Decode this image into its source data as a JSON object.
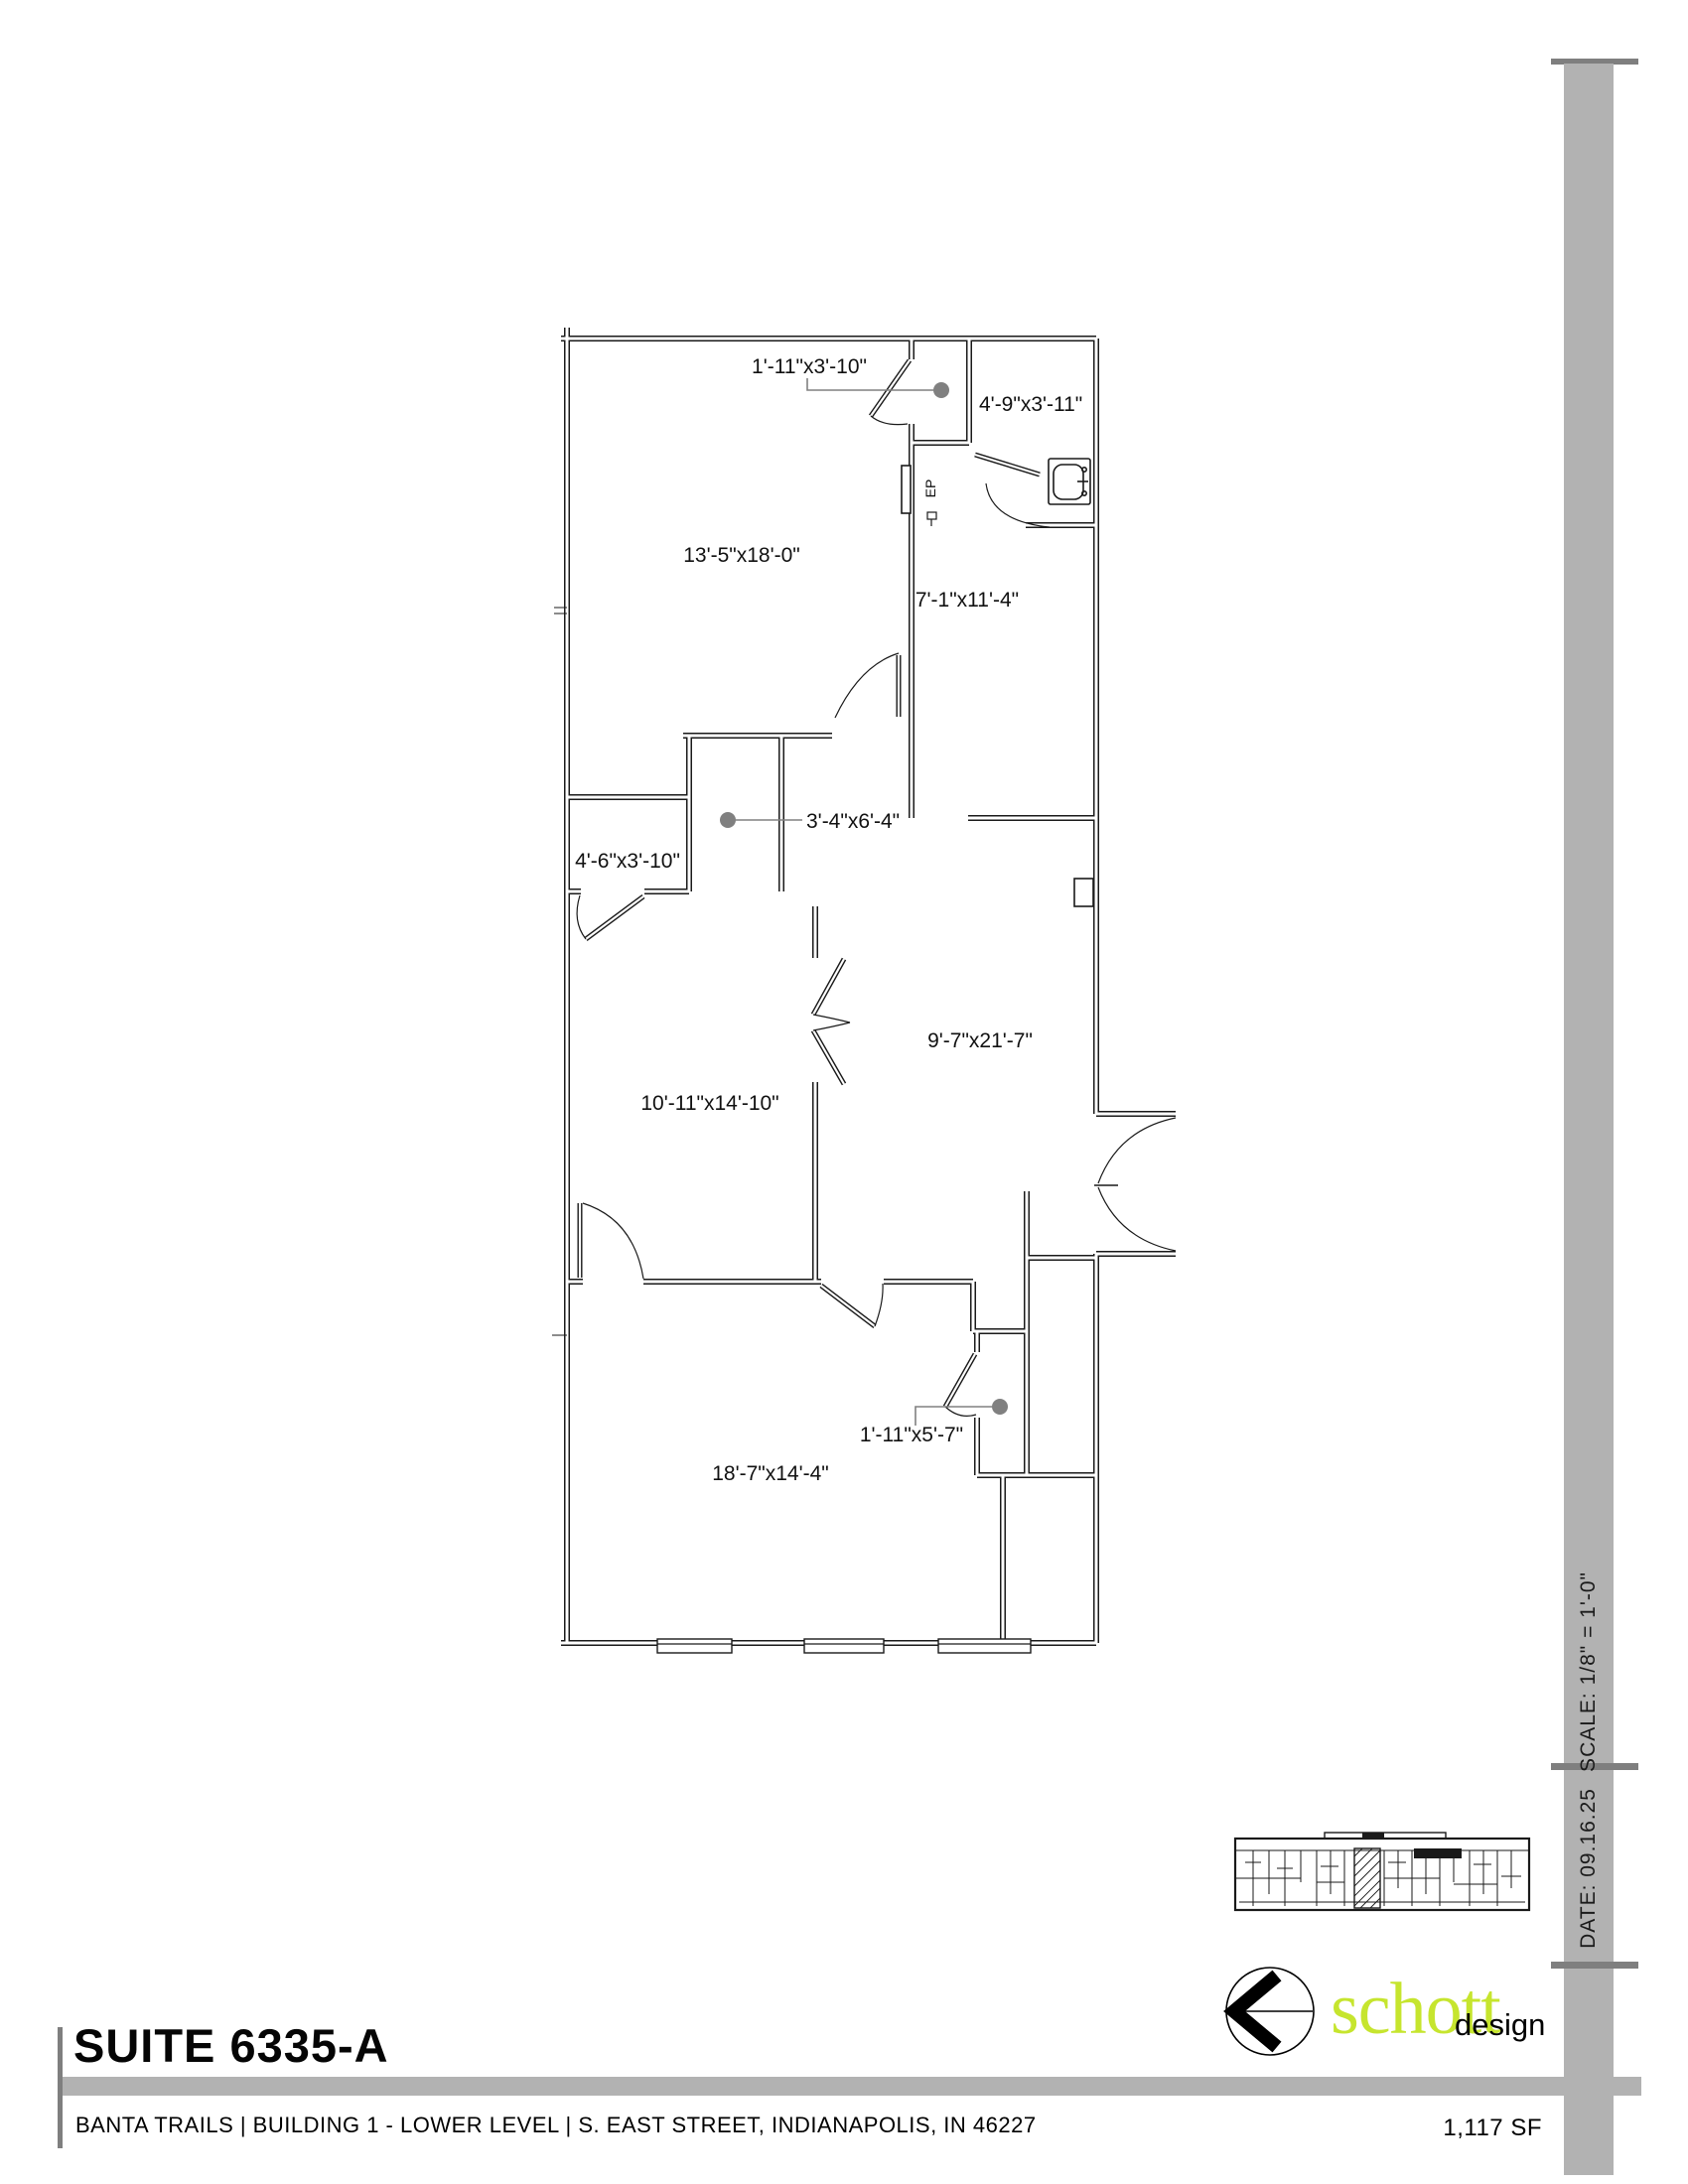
{
  "document": {
    "suite_title": "SUITE 6335-A",
    "footer_address": "BANTA TRAILS | BUILDING 1 - LOWER LEVEL | S. EAST STREET, INDIANAPOLIS, IN 46227",
    "area_label": "1,117 SF"
  },
  "title_block": {
    "scale_label": "SCALE: 1/8\" = 1'-0\"",
    "date_label": "DATE: 09.16.25"
  },
  "logo": {
    "word": "schott",
    "suffix": "design",
    "brand_color": "#c6e52e",
    "icon": "left-chevron-circle-icon"
  },
  "floor_plan": {
    "room_dimensions": [
      {
        "text": "1'-11\"x3'-10\""
      },
      {
        "text": "4'-9\"x3'-11\""
      },
      {
        "text": "13'-5\"x18'-0\""
      },
      {
        "text": "7'-1\"x11'-4\""
      },
      {
        "text": "3'-4\"x6'-4\""
      },
      {
        "text": "4'-6\"x3'-10\""
      },
      {
        "text": "9'-7\"x21'-7\""
      },
      {
        "text": "10'-11\"x14'-10\""
      },
      {
        "text": "1'-11\"x5'-7\""
      },
      {
        "text": "18'-7\"x14'-4\""
      }
    ],
    "annotations": [
      {
        "text": "EP"
      }
    ],
    "colors": {
      "wall_line": "#1a1a1a",
      "leader_gray": "#808080",
      "dot_gray": "#808080",
      "accent_gray": "#b2b2b2",
      "divider_gray": "#7f7f7f"
    }
  }
}
